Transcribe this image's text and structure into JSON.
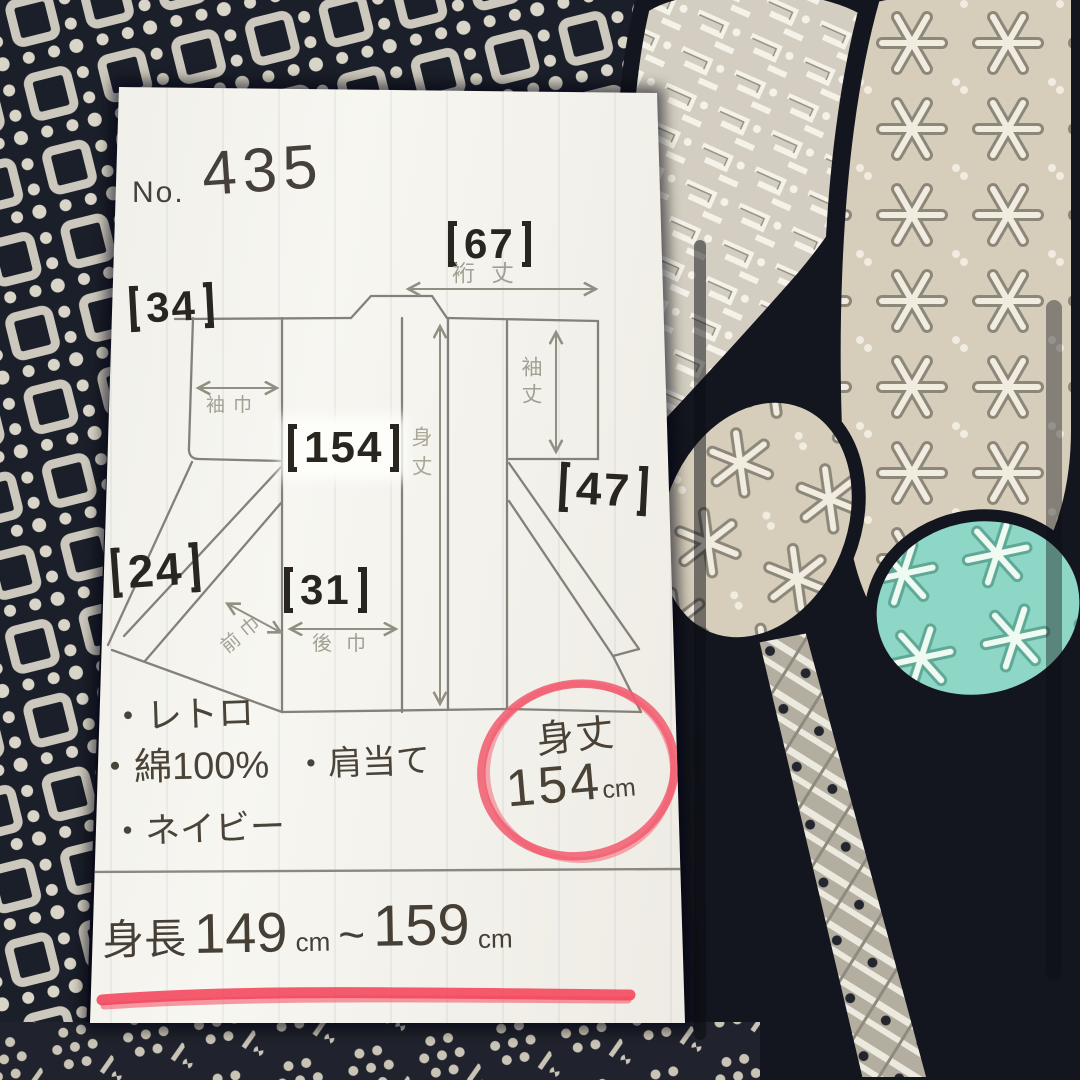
{
  "colors": {
    "fabric_navy": "#14161f",
    "paper": "#f2f1ea",
    "ink": "#46403a",
    "pencil": "#8d897c",
    "marker_red": "#f2556a",
    "teal_patch": "#8ed6c5"
  },
  "note": {
    "number_label": "No.",
    "number_value": "435",
    "diagram": {
      "yuki": {
        "value": "67",
        "label": "裄丈"
      },
      "sleeve_width": {
        "value": "34",
        "label": "袖巾"
      },
      "body_length": {
        "value": "154",
        "label": "身丈"
      },
      "sleeve_length": {
        "value": "47",
        "label": "袖丈"
      },
      "front_width": {
        "value": "24",
        "label": "前巾"
      },
      "back_width": {
        "value": "31",
        "label": "後巾"
      }
    },
    "bullets": [
      {
        "dot": "・",
        "text": "レトロ"
      },
      {
        "dot": "・",
        "text": "綿100%"
      },
      {
        "dot": "・",
        "text": "肩当て"
      },
      {
        "dot": "・",
        "text": "ネイビー"
      }
    ],
    "highlight": {
      "label": "身丈",
      "value": "154",
      "unit": "cm"
    },
    "height_range": {
      "label": "身長",
      "from": "149",
      "from_unit": "cm",
      "tilde": "~",
      "to": "159",
      "to_unit": "cm"
    }
  }
}
